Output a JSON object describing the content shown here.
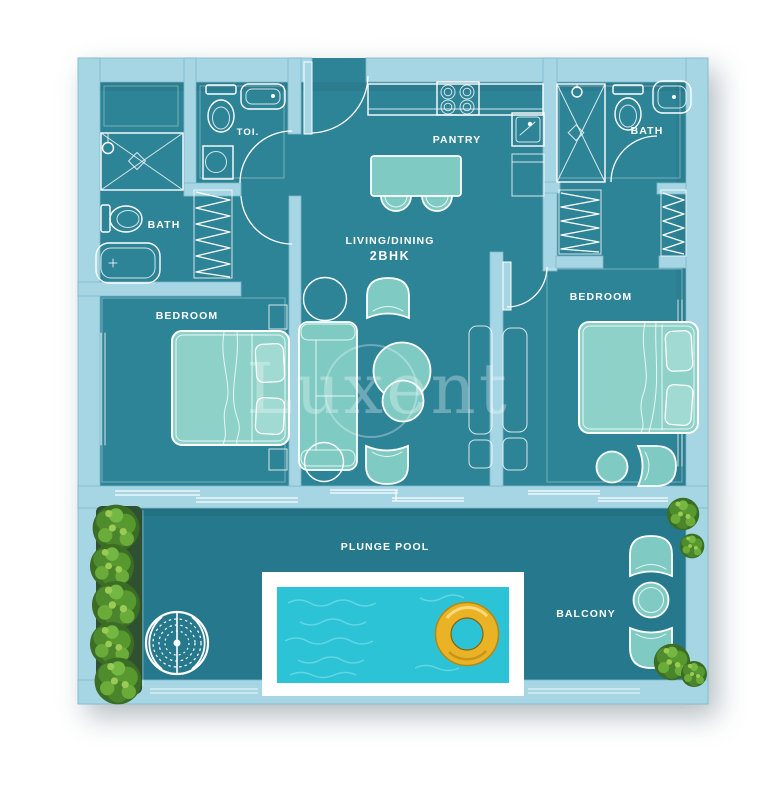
{
  "labels": {
    "bath_left": "BATH",
    "toilet_room": "TOI.",
    "pantry": "PANTRY",
    "living_dining": "LIVING/DINING",
    "unit_type": "2BHK",
    "bedroom_left": "BEDROOM",
    "bath_right": "BATH",
    "bedroom_right": "BEDROOM",
    "plunge_pool": "PLUNGE POOL",
    "balcony": "BALCONY"
  },
  "watermark": {
    "brand": "Luxent"
  },
  "colors": {
    "background": "#ffffff",
    "wall": "#a6d6e4",
    "floor_interior": "#2e8497",
    "floor_balcony": "#26798d",
    "furniture_fill": "#7fcbc3",
    "bed_fill": "#8ed1c9",
    "fixture_line": "#ffffff",
    "pool_water": "#2dc3d6",
    "pool_deck": "#ffffff",
    "float_ring_gold": "#eab225",
    "plant_green": "#4f8c2d",
    "planter_box": "#2f5131"
  }
}
